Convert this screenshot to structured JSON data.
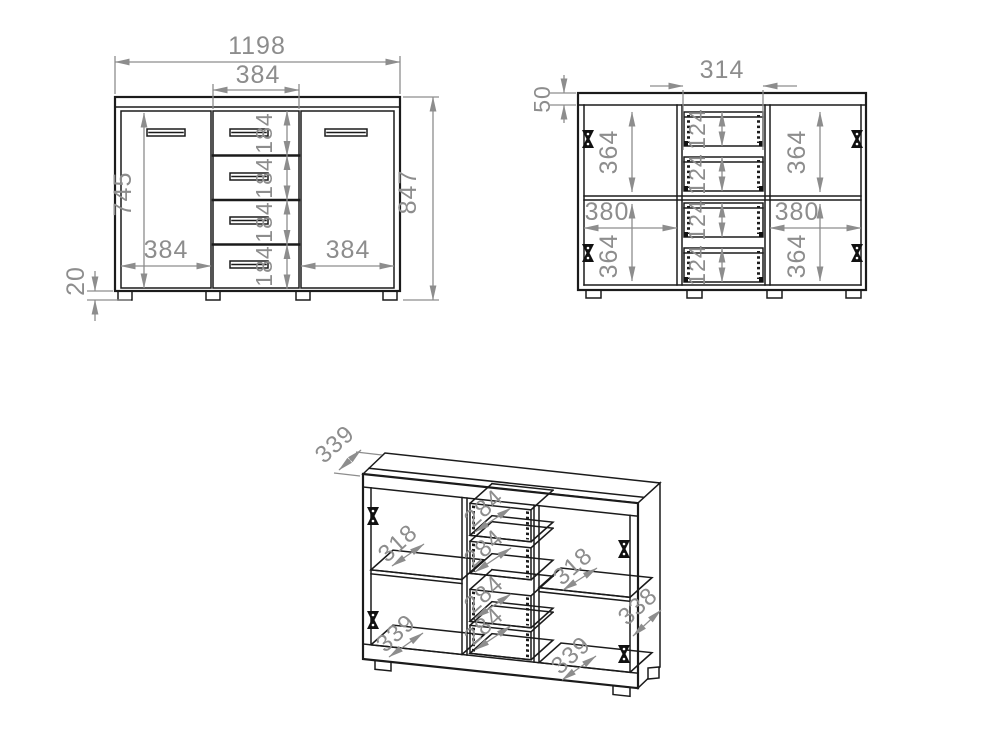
{
  "colors": {
    "line": "#1b1b1b",
    "dimension": "#8d8d8d",
    "background": "#ffffff"
  },
  "views": {
    "front": {
      "dims": {
        "overall_width": "1198",
        "drawer_col_width": "384",
        "door_height": "745",
        "drawer_h_1": "184",
        "drawer_h_2": "184",
        "drawer_h_3": "184",
        "drawer_h_4": "184",
        "left_door_width": "384",
        "right_door_width": "384",
        "overall_height": "847",
        "plinth_height": "20"
      }
    },
    "internal": {
      "dims": {
        "top_panel": "50",
        "inner_drawer_width": "314",
        "upper_left_h": "364",
        "upper_right_h": "364",
        "lower_left_w": "380",
        "lower_right_w": "380",
        "lower_left_h": "364",
        "lower_right_h": "364",
        "box_h_1": "124",
        "box_h_2": "124",
        "box_h_3": "124",
        "box_h_4": "124"
      }
    },
    "perspective": {
      "dims": {
        "top_depth": "339",
        "shelf_ul": "318",
        "floor_ll": "339",
        "box_d_1": "284",
        "box_d_2": "284",
        "box_d_3": "284",
        "box_d_4": "284",
        "shelf_ur": "318",
        "floor_lr": "339",
        "side_depth": "338"
      }
    }
  }
}
